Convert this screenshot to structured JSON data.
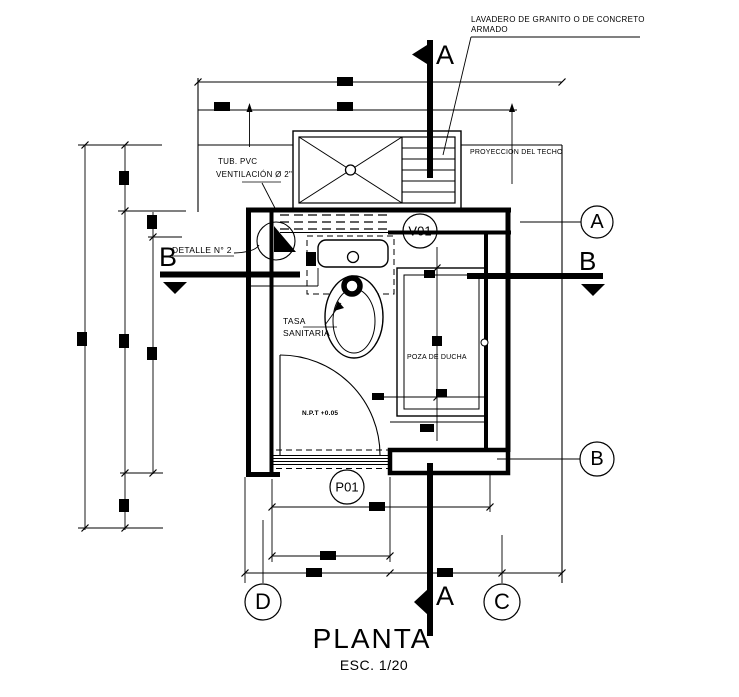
{
  "title": {
    "text": "PLANTA",
    "scale": "ESC. 1/20"
  },
  "annotations": {
    "lavadero1": "LAVADERO DE GRANITO O DE CONCRETO",
    "lavadero2": "ARMADO",
    "proyeccion": "PROYECCION DEL TECHO",
    "tub1": "TUB.  PVC",
    "tub2": "VENTILACIÓN Ø 2\"",
    "detalle": "DETALLE N° 2",
    "tasa1": "TASA",
    "tasa2": "SANITARIA",
    "poza": "POZA DE DUCHA",
    "npt": "N.P.T +0.05"
  },
  "openings": {
    "window_label": "V01",
    "door_label": "P01"
  },
  "sections": {
    "a": "A",
    "b": "B"
  },
  "grid": {
    "a": "A",
    "b": "B",
    "c": "C",
    "d": "D"
  },
  "colors": {
    "ink": "#000000",
    "paper": "#ffffff"
  }
}
